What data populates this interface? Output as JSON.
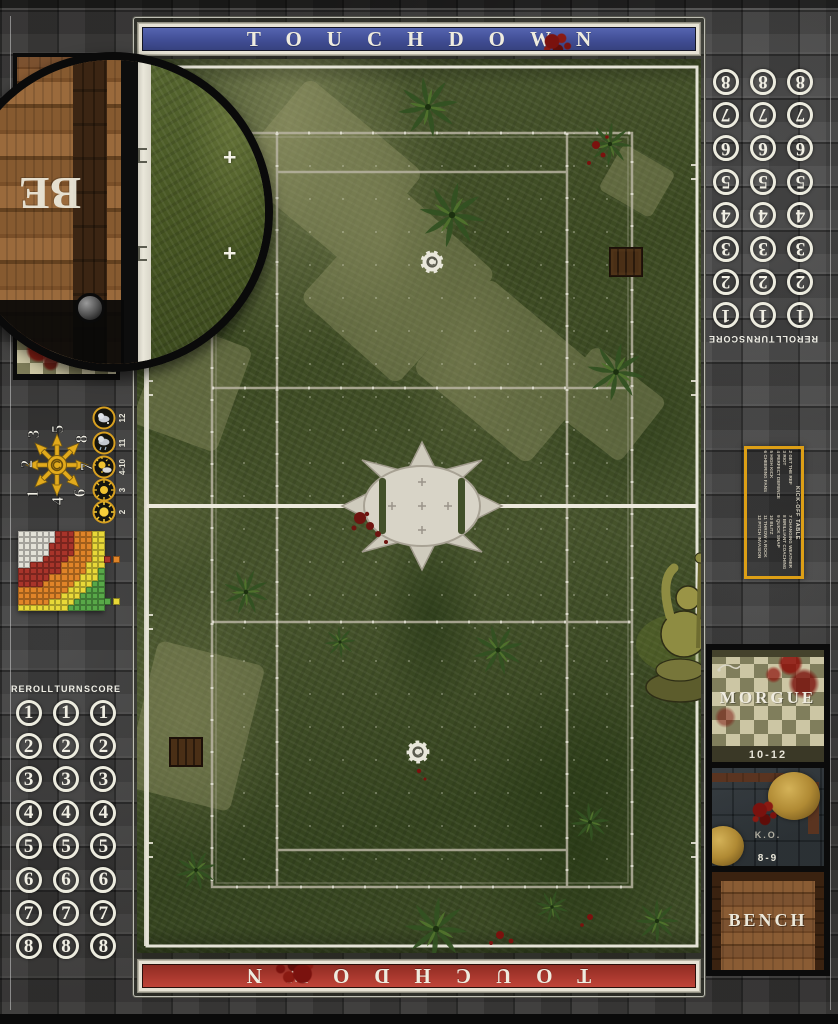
{
  "banners": {
    "top": {
      "label": "TOUCHDOWN",
      "color": "#47549b"
    },
    "bottom": {
      "label": "TOUCHDOWN",
      "color": "#b2392e"
    }
  },
  "score_track": {
    "headers": [
      "REROLL",
      "TURN",
      "SCORE"
    ],
    "numbers": [
      "1",
      "2",
      "3",
      "4",
      "5",
      "6",
      "7",
      "8"
    ]
  },
  "scatter_template": {
    "numbers": [
      "1",
      "2",
      "3",
      "4",
      "5",
      "6",
      "7",
      "8"
    ],
    "arrow_color": "#e2aa1c"
  },
  "weather_table": {
    "ring_color": "#d8a020",
    "rows": [
      {
        "value": "12",
        "icon": "snow-cloud"
      },
      {
        "value": "11",
        "icon": "rain-cloud"
      },
      {
        "value": "4-10",
        "icon": "sun-cloud"
      },
      {
        "value": "3",
        "icon": "sun-small"
      },
      {
        "value": "2",
        "icon": "sun"
      }
    ]
  },
  "range_ruler": {
    "bands": [
      {
        "name": "origin",
        "color": "#e3e1d8"
      },
      {
        "name": "quick-pass",
        "color": "#a8342a"
      },
      {
        "name": "short-pass",
        "color": "#e08428"
      },
      {
        "name": "long-pass",
        "color": "#e8d838"
      },
      {
        "name": "long-bomb",
        "color": "#58a848"
      }
    ],
    "legend_top": [
      "#a8342a",
      "#e08428"
    ],
    "legend_bottom": [
      "#58a848",
      "#e8d838"
    ]
  },
  "kickoff_table": {
    "title": "KICK-OFF TABLE",
    "border_color": "#dd9f16",
    "entries": [
      "2 GET THE REF",
      "3 RIOT",
      "4 PERFECT DEFENCE",
      "5 HIGH KICK",
      "6 CHEERING FANS",
      "7 CHANGING WEATHER",
      "8 BRILLIANT COACHING",
      "9 QUICK SNAP",
      "10 BLITZ",
      "11 THROW A ROCK",
      "12 PITCH INVASION"
    ]
  },
  "dugout": {
    "morgue": {
      "label": "MORGUE",
      "range": "10-12"
    },
    "ko": {
      "label": "K.O.",
      "range": "8-9"
    },
    "bench": {
      "label": "BENCH"
    }
  },
  "zoom_inset": {
    "visible_letters": "BE"
  },
  "field": {
    "line_color": "#d9d6c8",
    "midline_color": "#ece9dc"
  }
}
